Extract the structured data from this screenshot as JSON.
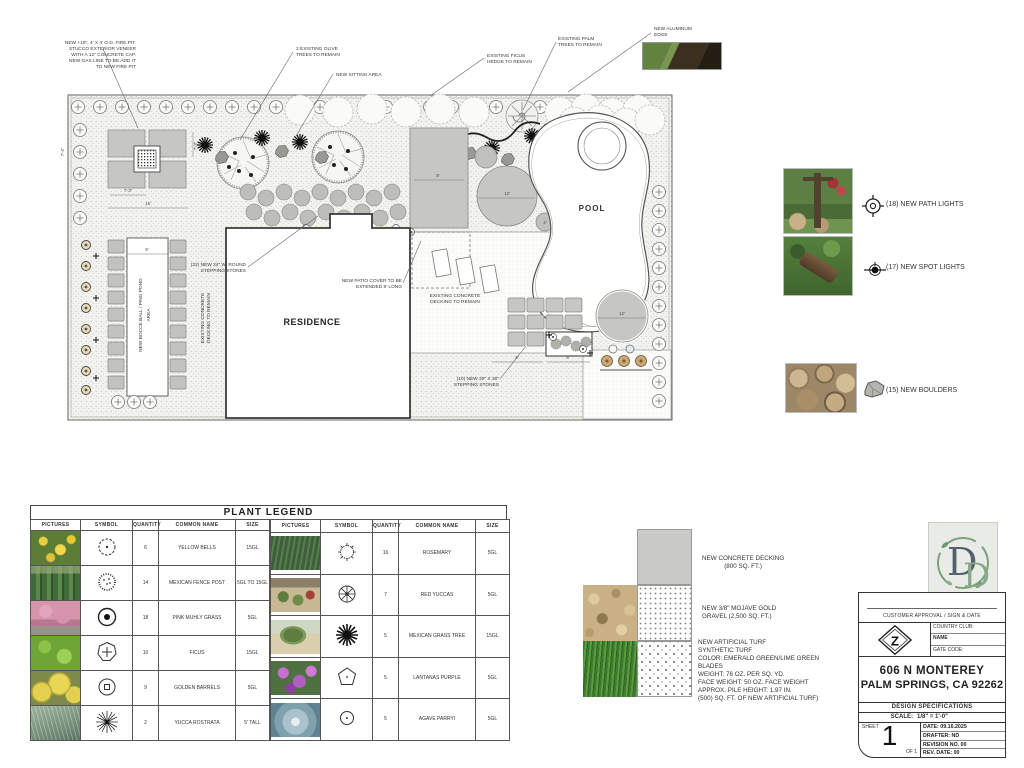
{
  "plan": {
    "labels": {
      "residence": "RESIDENCE",
      "pool": "POOL"
    },
    "ann": {
      "firepit1": "NEW +18\", 4' X 4' O.D. FIRE PIT.",
      "firepit2": "STUCCO EXTERIOR VENEER",
      "firepit3": "WITH A 12\" CONCRETE CAP.",
      "firepit4": "NEW GAS LINE TO BE ADD IT",
      "firepit5": "TO NEW FIRE PIT",
      "olive1": "2 EXISTING OLIVE",
      "olive2": "TREES TO REMAIN",
      "sitting": "NEW SITTING AREA",
      "ficus1": "EXISTING FICUS",
      "ficus2": "HEDGE TO REMAIN",
      "palm1": "EXISTING PALM",
      "palm2": "TREES TO REMAIN",
      "alum1": "NEW ALUMINUM",
      "alum2": "EDGE",
      "round1": "(22) NEW 24\" W. ROUND",
      "round2": "STEPPING STONES",
      "patio1": "NEW PATIO COVER TO BE",
      "patio2": "EXTENDED 8' LONG",
      "deck1": "EXISTING CONCRETE",
      "deck2": "DECKING TO REMAIN",
      "sq1": "(10) NEW 30\" X 30\"",
      "sq2": "STEPPING STONES",
      "bocce1": "NEW BOCCE BALL / PING PONG",
      "bocce2": "AREA",
      "deckl1": "EXISTING CONCRETE",
      "deckl2": "DECKING TO REMAIN"
    },
    "dims": {
      "a": "7'-3\"",
      "b": "7'-3\"",
      "c": "15'",
      "d": "9'",
      "e": "12'",
      "f": "12'",
      "g": "4'",
      "h": "8'",
      "i": "8'",
      "j": "7'-4\"",
      "k": "8'"
    }
  },
  "site_legend": {
    "path_lights": "(18) NEW PATH LIGHTS",
    "spot_lights": "(17) NEW SPOT LIGHTS",
    "boulders": "(15) NEW BOULDERS"
  },
  "plant_legend": {
    "title": "PLANT LEGEND",
    "headers": [
      "PICTURES",
      "SYMBOL",
      "QUANTITY",
      "COMMON NAME",
      "SIZE"
    ],
    "left_rows": [
      {
        "qty": "6",
        "name": "YELLOW BELLS",
        "size": "15GL"
      },
      {
        "qty": "14",
        "name": "MEXICAN FENCE POST",
        "size": "5GL TO 15GL"
      },
      {
        "qty": "18",
        "name": "PINK MUHLY GRASS",
        "size": "5GL"
      },
      {
        "qty": "10",
        "name": "FICUS",
        "size": "15GL"
      },
      {
        "qty": "9",
        "name": "GOLDEN BARRELS",
        "size": "5GL"
      },
      {
        "qty": "2",
        "name": "YUCCA ROSTRATA",
        "size": "5' TALL"
      }
    ],
    "right_rows": [
      {
        "qty": "16",
        "name": "ROSEMARY",
        "size": "5GL"
      },
      {
        "qty": "7",
        "name": "RED YUCCAS",
        "size": "5GL"
      },
      {
        "qty": "5",
        "name": "MEXICAN GRASS TREE",
        "size": "15GL"
      },
      {
        "qty": "5",
        "name": "LANTANAS PURPLE",
        "size": "5GL"
      },
      {
        "qty": "5",
        "name": "AGAVE PARRYI",
        "size": "5GL"
      }
    ]
  },
  "materials": {
    "concrete1": "NEW CONCRETE DECKING",
    "concrete2": "(800 SQ. FT.)",
    "gravel1": "NEW 3/8\" MOJAVE GOLD",
    "gravel2": "GRAVEL (2,500 SQ. FT.)",
    "turf": [
      "NEW ARTIFICIAL TURF",
      "SYNTHETIC TURF",
      "COLOR: EMERALD GREEN/LIME GREEN",
      "BLADES",
      "WEIGHT: 76 OZ. PER SQ. YD.",
      "FACE WEIGHT: 50 OZ. FACE WEIGHT",
      "APPROX. PILE HEIGHT: 1.97 IN.",
      "(500) SQ. FT. OF NEW ARTIFICIAL TURF)"
    ]
  },
  "title_block": {
    "approval": "CUSTOMER APPROVAL / SIGN & DATE",
    "country_club": "COUNTRY CLUB:",
    "name": "NAME",
    "gate_code": "GATE CODE:",
    "address_l1": "606 N MONTEREY",
    "address_l2": "PALM SPRINGS, CA 92262",
    "design_specs": "DESIGN SPECIFICATIONS",
    "scale_label": "SCALE:",
    "scale_value": "1/8\" = 1'-0\"",
    "sheet_label": "SHEET",
    "sheet_number": "1",
    "of_label": "OF 1",
    "date": "DATE: 09.16.2025",
    "drafter": "DRAFTER: ND",
    "revision": "REVISION NO. 00",
    "rev_date": "REV. DATE: 00",
    "logo_d1": "D",
    "logo_d2": "D",
    "logo_z": "Z",
    "accent_green": "#7aa37a",
    "accent_slate": "#55606e"
  }
}
